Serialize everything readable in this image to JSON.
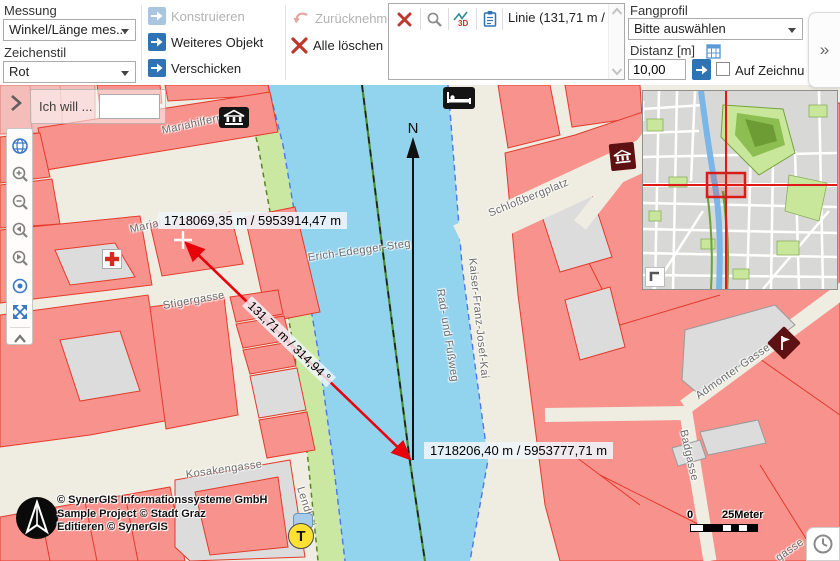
{
  "colors": {
    "accent_blue": "#2E74B5",
    "danger_red": "#BE392D",
    "measure_red": "#E8000A",
    "building_fill": "#F8928D",
    "building_stroke": "#E23B2B",
    "water": "#92D3EE",
    "greenbank": "#CBE8A3",
    "street_bg": "#EFEDE1",
    "overview_crosshair": "#E01818"
  },
  "toolbar": {
    "measurement": {
      "group_label": "Messung",
      "tool_value": "Winkel/Länge mes...",
      "style_label": "Zeichenstil",
      "style_value": "Rot"
    },
    "actions": {
      "construct": "Konstruieren",
      "another_object": "Weiteres Objekt",
      "send": "Verschicken",
      "undo": "Zurücknehmen",
      "delete_all": "Alle löschen"
    },
    "results": {
      "selected_item": "Linie (131,71 m / ...",
      "icons": [
        "delete-icon",
        "zoom-to-icon",
        "profile-3d-icon",
        "report-icon"
      ]
    },
    "snapping": {
      "group_label": "Fangprofil",
      "profile_value": "Bitte auswählen",
      "distance_label": "Distanz [m]",
      "distance_value": "10,00",
      "snap_checkbox_label": "Auf Zeichnung fang",
      "checkbox_checked": false
    },
    "expand_button": "»"
  },
  "map": {
    "search_label": "Ich will ...",
    "search_value": "",
    "north_label": "N",
    "measurement": {
      "start_coords": "1718069,35 m / 5953914,47 m",
      "end_coords": "1718206,40 m / 5953777,71 m",
      "segment_label": "131,71 m / 314,94 °"
    },
    "streets": [
      {
        "text": "Mariahilferplatz"
      },
      {
        "text": "Mariahilf"
      },
      {
        "text": "Stigergasse"
      },
      {
        "text": "Kosakengasse"
      },
      {
        "text": "Lendkai"
      },
      {
        "text": "Erich-Edegger-Steg"
      },
      {
        "text": "Kaiser-Franz-Josef-Kai"
      },
      {
        "text": "Rad- und Fußweg"
      },
      {
        "text": "Schloßbergplatz"
      },
      {
        "text": "Admonter Gasse"
      },
      {
        "text": "Badgasse"
      },
      {
        "text": "gasse"
      }
    ],
    "copyright_lines": [
      "© SynerGIS Informationssysteme GmbH",
      "Sample Project © Stadt Graz",
      "Editieren © SynerGIS"
    ],
    "scalebar": {
      "start": "0",
      "end": "25Meter"
    },
    "poi_icons": [
      "museum-icon",
      "hotel-icon",
      "pharmacy-icon",
      "landmark-pin-icon",
      "flag-icon",
      "taxi-icon",
      "clock-icon"
    ]
  }
}
